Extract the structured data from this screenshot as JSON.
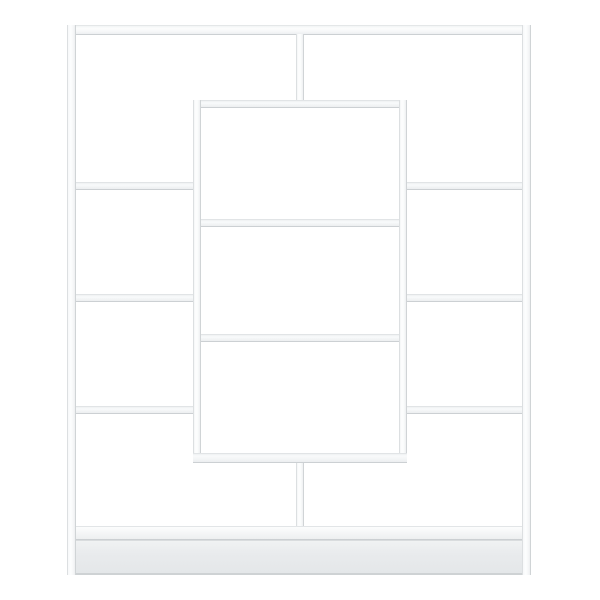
{
  "page": {
    "background_color": "#ffffff"
  },
  "product_image": {
    "subject": "White geometric open bookcase with offset side shelves and a protruding center display box",
    "view": "straight-on product photo on plain white background",
    "compartments": 11,
    "colors": {
      "background": "#ffffff",
      "panel_white": "#fcfdfd",
      "edge_light": "#e3e6e8",
      "edge_dark": "#ccd0d3",
      "shelf_fill": "#f2f4f5",
      "plinth_gray": "#e7e9eb"
    },
    "parts": {
      "outer_top_bar": "top panel",
      "outer_left_leg": "left side panel",
      "outer_right_leg": "right side panel",
      "center_divider_upper": "center divider above box",
      "center_divider_lower": "center divider below box",
      "center_box": "protruding center box with two inner shelves",
      "left_shelf_count": 3,
      "right_shelf_count": 3,
      "bottom_shelf": "bottom panel",
      "plinth": "base plinth"
    }
  }
}
